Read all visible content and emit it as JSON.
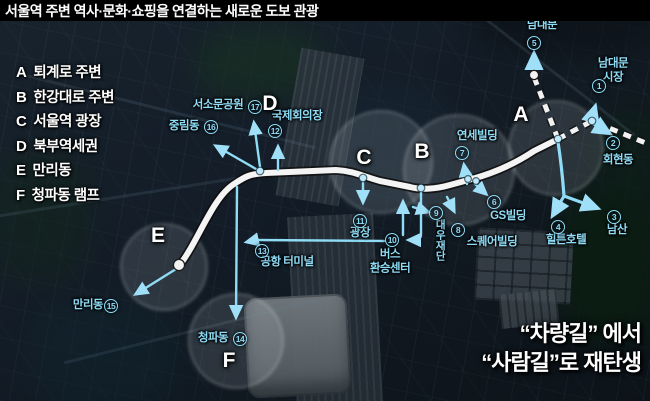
{
  "title": "서울역 주변 역사·문화·쇼핑을 연결하는 새로운 도보 관광",
  "legend": {
    "items": [
      {
        "key": "A",
        "label": "퇴계로 주변"
      },
      {
        "key": "B",
        "label": "한강대로 주변"
      },
      {
        "key": "C",
        "label": "서울역 광장"
      },
      {
        "key": "D",
        "label": "북부역세권"
      },
      {
        "key": "E",
        "label": "만리동"
      },
      {
        "key": "F",
        "label": "청파동 램프"
      }
    ]
  },
  "headline": {
    "line1": "“차량길” 에서",
    "line2": "“사람길”로 재탄생"
  },
  "map": {
    "zone_letters": [
      {
        "letter": "A",
        "x": 521,
        "y": 115
      },
      {
        "letter": "B",
        "x": 422,
        "y": 152
      },
      {
        "letter": "C",
        "x": 364,
        "y": 158
      },
      {
        "letter": "D",
        "x": 270,
        "y": 104
      },
      {
        "letter": "E",
        "x": 158,
        "y": 236
      },
      {
        "letter": "F",
        "x": 229,
        "y": 361
      }
    ],
    "labels": [
      {
        "num": "5",
        "nx": 534,
        "ny": 43,
        "text": "남대문",
        "tx": 542,
        "ty": 26
      },
      {
        "num": "1",
        "nx": 599,
        "ny": 86,
        "text": "남대문 시장",
        "tx": 613,
        "ty": 71
      },
      {
        "num": "2",
        "nx": 613,
        "ny": 143,
        "text": "회현동",
        "tx": 618,
        "ty": 161
      },
      {
        "num": "3",
        "nx": 614,
        "ny": 217,
        "text": "남산",
        "tx": 617,
        "ty": 231
      },
      {
        "num": "4",
        "nx": 558,
        "ny": 227,
        "text": "힐튼호텔",
        "tx": 566,
        "ty": 241
      },
      {
        "num": "6",
        "nx": 494,
        "ny": 202,
        "text": "GS빌딩",
        "tx": 508,
        "ty": 217
      },
      {
        "num": "7",
        "nx": 462,
        "ny": 153,
        "text": "연세빌딩",
        "tx": 477,
        "ty": 137
      },
      {
        "num": "8",
        "nx": 458,
        "ny": 230,
        "text": "스퀘어빌딩",
        "tx": 492,
        "ty": 243
      },
      {
        "num": "9",
        "nx": 436,
        "ny": 213,
        "text": "대우재단",
        "tx": 440,
        "ty": 240,
        "vertical": true
      },
      {
        "num": "10",
        "nx": 392,
        "ny": 240,
        "text": "버스\n환승센터",
        "tx": 390,
        "ty": 262
      },
      {
        "num": "11",
        "nx": 360,
        "ny": 221,
        "text": "광장",
        "tx": 360,
        "ty": 234
      },
      {
        "num": "12",
        "nx": 275,
        "ny": 131,
        "text": "국제회의장",
        "tx": 297,
        "ty": 117
      },
      {
        "num": "13",
        "nx": 262,
        "ny": 251,
        "text": "공항 터미널",
        "tx": 287,
        "ty": 263
      },
      {
        "num": "14",
        "nx": 240,
        "ny": 339,
        "text": "청파동",
        "tx": 213,
        "ty": 339
      },
      {
        "num": "15",
        "nx": 111,
        "ny": 306,
        "text": "만리동",
        "tx": 88,
        "ty": 306
      },
      {
        "num": "16",
        "nx": 211,
        "ny": 127,
        "text": "중림동",
        "tx": 184,
        "ty": 127
      },
      {
        "num": "17",
        "nx": 255,
        "ny": 107,
        "text": "서소문공원",
        "tx": 218,
        "ty": 106
      }
    ]
  },
  "colors": {
    "accent_cyan": "#8fdcf6",
    "route_white": "#f4f4f4",
    "route_casing": "#111111",
    "title_bg": "#000000",
    "headline_text": "#ffffff",
    "zone_circle": "#dfe8ee"
  }
}
